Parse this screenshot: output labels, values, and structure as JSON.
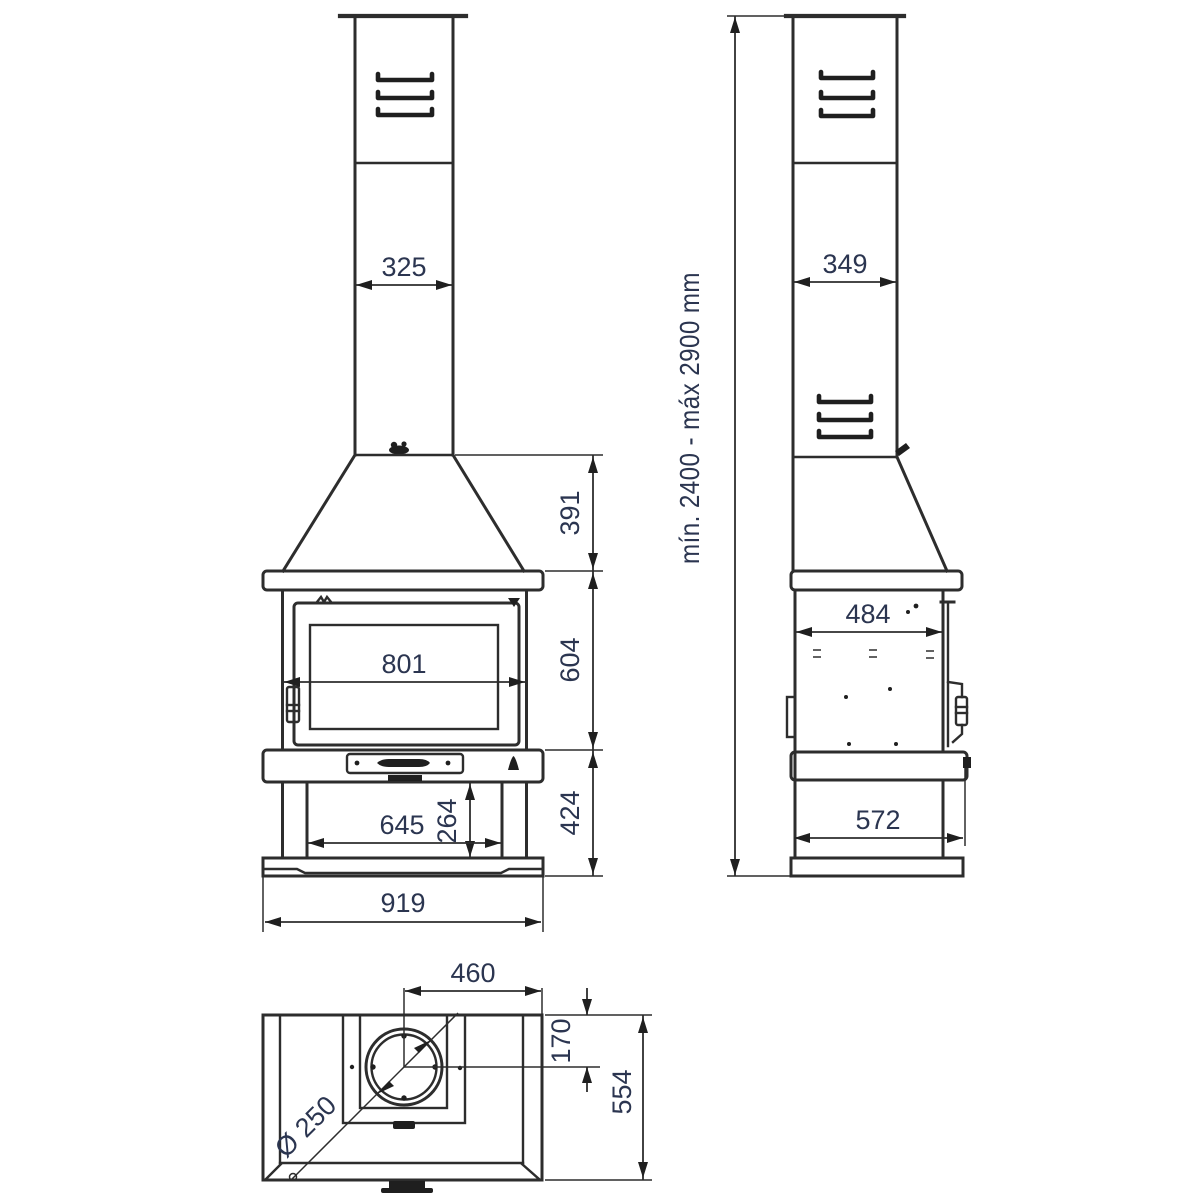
{
  "drawing": {
    "front_view": {
      "chimney_width_label": "325",
      "hood_height_label": "391",
      "door_width_label": "801",
      "firebox_height_label": "604",
      "lower_section_height_label": "424",
      "log_store_width_label": "645",
      "log_store_height_label": "264",
      "overall_width_label": "919"
    },
    "side_view": {
      "chimney_depth_label": "349",
      "height_range_label": "mín. 2400 - máx 2900 mm",
      "body_depth_label": "484",
      "base_depth_label": "572"
    },
    "top_view": {
      "flue_center_offset_label": "460",
      "flue_back_offset_label": "170",
      "overall_depth_label": "554",
      "flue_diameter_label": "Ø 250"
    },
    "colors": {
      "line": "#2d2d2d",
      "dimension_text": "#2b3550",
      "background": "#ffffff"
    }
  }
}
